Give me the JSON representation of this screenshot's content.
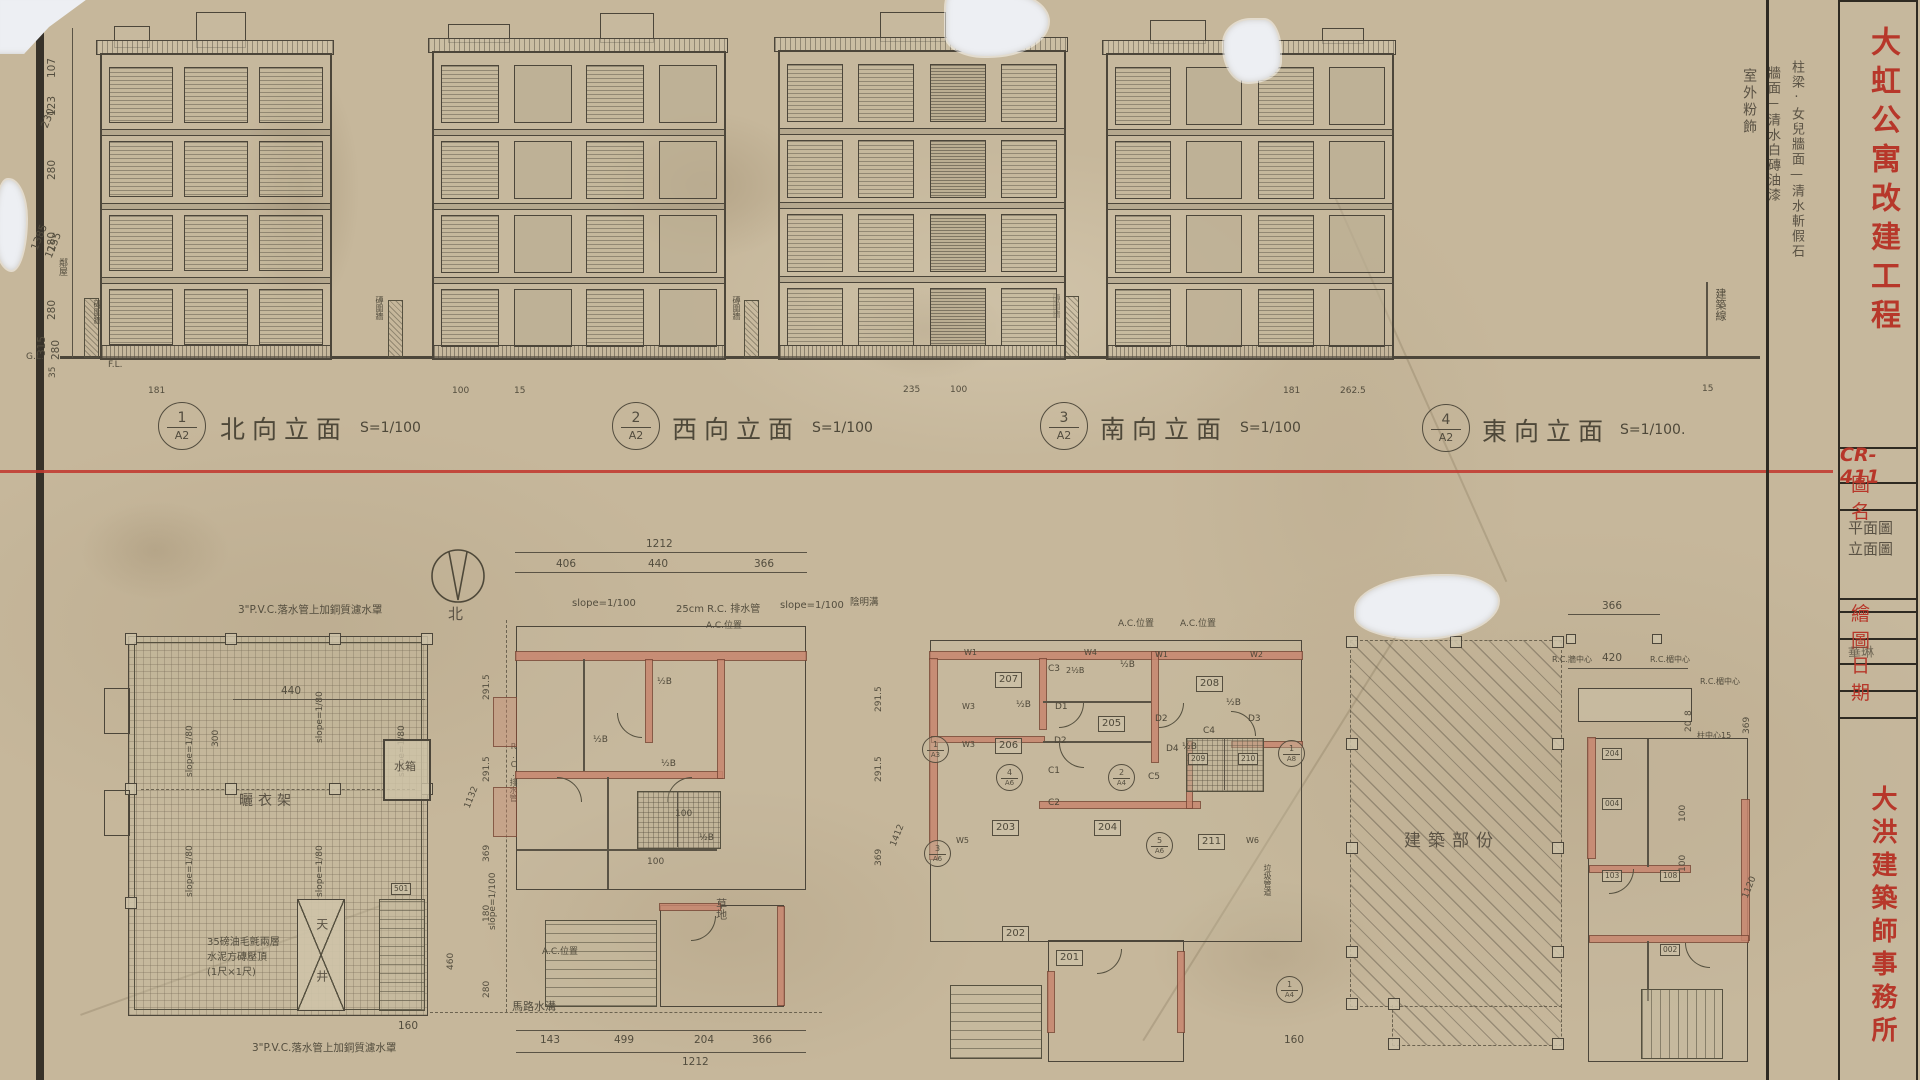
{
  "sheet": {
    "project_title": "大虹公寓改建工程",
    "drawing_no": "CR-411",
    "title_block": {
      "field_drawing_name": "圖名",
      "drawing_name_line1": "平面圖",
      "drawing_name_line2": "立面圖",
      "field_drafter": "繪圖",
      "drafter": "華琳",
      "field_date": "日期",
      "firm": "大洪建築師事務所"
    },
    "finish_notes": {
      "line1": "柱梁·女兒牆面—清水斬假石",
      "line2": "牆面—清水白磚油漆",
      "line3": "室外粉飾"
    },
    "building_line": "建築線",
    "fence_note": "磚圍牆",
    "neighbor_note": "鄰屋"
  },
  "elevations": {
    "labels": [
      {
        "num": "1",
        "sheet": "A2",
        "name": "北向立面",
        "scale": "S=1/100"
      },
      {
        "num": "2",
        "sheet": "A2",
        "name": "西向立面",
        "scale": "S=1/100"
      },
      {
        "num": "3",
        "sheet": "A2",
        "name": "南向立面",
        "scale": "S=1/100"
      },
      {
        "num": "4",
        "sheet": "A2",
        "name": "東向立面",
        "scale": "S=1/100."
      }
    ],
    "left_dims": {
      "d1": "107",
      "d2": "123",
      "d3": "280",
      "d4": "280",
      "d5": "280",
      "d6": "315",
      "d7": "280",
      "d8": "35",
      "diag1": "1385",
      "diag2": "1155",
      "diag3": "230"
    },
    "gl": "G.L.",
    "fl": "F.L.",
    "base_dims": {
      "b1": "181",
      "b2": "100",
      "b3": "15",
      "b4": "235",
      "b5": "100",
      "b6": "181",
      "b7": "262.5",
      "b8": "15"
    }
  },
  "plans": {
    "roof": {
      "pvc_note": "3\"P.V.C.落水管上加銅質濾水罩",
      "membrane1": "35磅油毛氈兩層",
      "membrane2": "水泥方磚壓頂",
      "membrane3": "(1尺×1尺)",
      "slope": "slope=1/80",
      "drying_rack": "曬衣架",
      "water_tank": "水箱",
      "light_well": "天井",
      "tag": "501",
      "dim_440": "440",
      "dim_300": "300",
      "dim_160": "160"
    },
    "plan_b": {
      "north": "北",
      "total_top": "1212",
      "top1": "406",
      "top2": "440",
      "top3": "366",
      "bot1": "143",
      "bot2": "499",
      "bot3": "204",
      "bot4": "366",
      "total_bottom": "1212",
      "l1": "291.5",
      "l2": "291.5",
      "l3": "369",
      "l4": "180",
      "l5": "280",
      "l6": "460",
      "l_total": "1132",
      "slope": "slope=1/100",
      "drain": "25cm R.C. 排水管",
      "ac": "A.C.位置",
      "grass": "草地",
      "road": "馬路水溝",
      "rc_drain": "R.C.排水管",
      "half_b": "½B",
      "dim100": "100"
    },
    "plan_c": {
      "rooms": [
        "207",
        "206",
        "205",
        "208",
        "203",
        "204",
        "211",
        "209",
        "210",
        "201",
        "202"
      ],
      "w_tags": [
        "W1",
        "W2",
        "W3",
        "W4",
        "W5",
        "W6"
      ],
      "c_tags": [
        "C1",
        "C2",
        "C3",
        "C4",
        "C5"
      ],
      "d_tags": [
        "D1",
        "D2",
        "D3",
        "D4"
      ],
      "half_b": "½B",
      "two_half_b": "2½B",
      "markers": [
        {
          "n": "1",
          "s": "A3"
        },
        {
          "n": "4",
          "s": "A6"
        },
        {
          "n": "2",
          "s": "A4"
        },
        {
          "n": "3",
          "s": "A6"
        },
        {
          "n": "5",
          "s": "A6"
        },
        {
          "n": "1",
          "s": "A8"
        },
        {
          "n": "1",
          "s": "A4"
        }
      ],
      "l1": "291.5",
      "l2": "291.5",
      "l3": "369",
      "l_total": "1412",
      "ac": "A.C.位置",
      "gutter": "陰明溝",
      "slope": "slope=1/100",
      "trash": "垃圾管道",
      "dim160": "160"
    },
    "existing": {
      "label": "建築部份"
    },
    "plan_e": {
      "dim366": "366",
      "rc_wall": "R.C.牆中心",
      "dim420": "420",
      "rc_lintel": "R.C.楣中心",
      "col_note": "柱中心15",
      "dim8": "8",
      "dim20": "20",
      "dim100": "100",
      "rooms": [
        "204",
        "004",
        "103",
        "108",
        "002"
      ],
      "r_dim1": "369",
      "r_dim2": "1120"
    }
  }
}
